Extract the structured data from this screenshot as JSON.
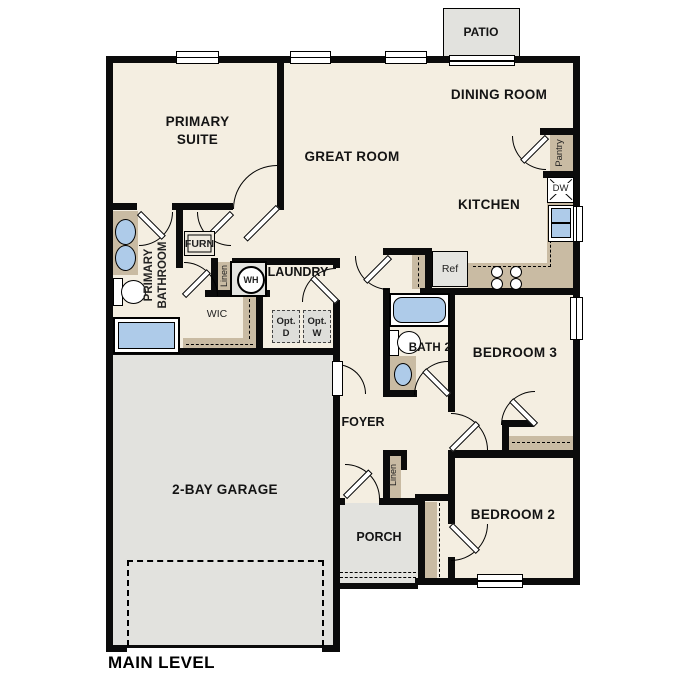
{
  "plan": {
    "title": "MAIN LEVEL",
    "rooms": {
      "primary_suite": "PRIMARY SUITE",
      "great_room": "GREAT ROOM",
      "dining_room": "DINING ROOM",
      "kitchen": "KITCHEN",
      "patio": "PATIO",
      "laundry": "LAUNDRY",
      "primary_bathroom": "PRIMARY BATHROOM",
      "wic": "WIC",
      "bath2": "BATH 2",
      "bedroom3": "BEDROOM 3",
      "bedroom2": "BEDROOM 2",
      "foyer": "FOYER",
      "garage": "2-BAY GARAGE",
      "porch": "PORCH"
    },
    "features": {
      "pantry": "Pantry",
      "dishwasher": "DW",
      "refrigerator": "Ref",
      "furnace": "FURN",
      "water_heater": "WH",
      "linen1": "Linen",
      "linen2": "Linen",
      "opt_dryer": "Opt. D",
      "opt_washer": "Opt. W"
    },
    "colors": {
      "floor": "#F4EEE1",
      "outdoor": "#E2E2DE",
      "cabinet": "#C9BBA3",
      "fixture_blue": "#AECBE9",
      "wall": "#0B0B0B"
    }
  }
}
